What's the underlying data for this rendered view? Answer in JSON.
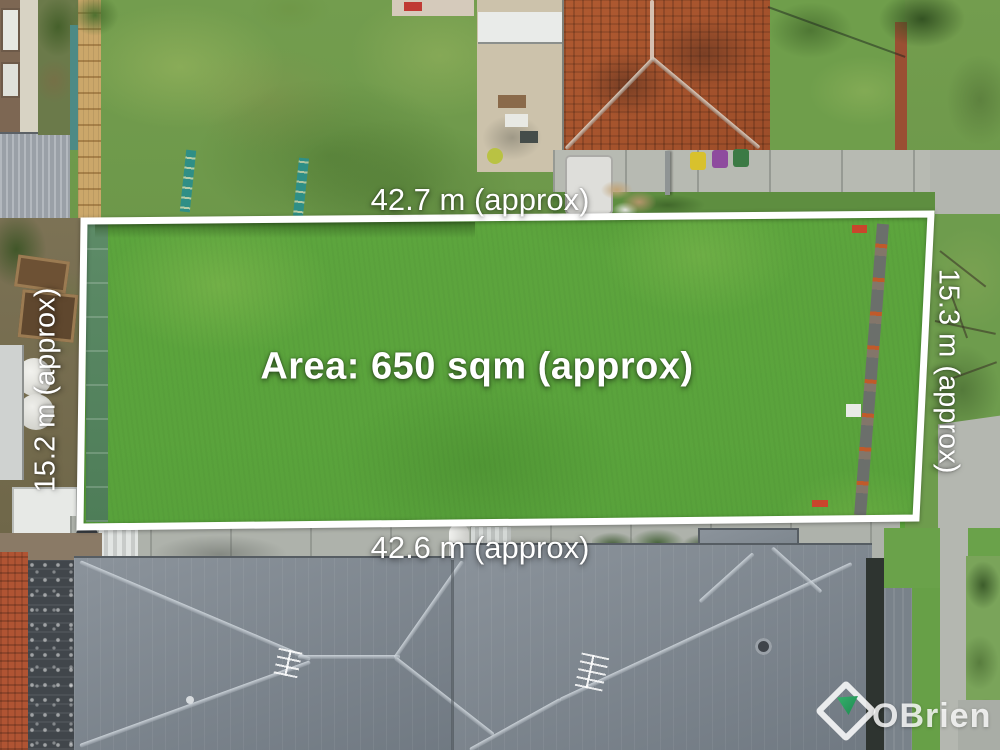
{
  "image": {
    "type": "aerial-property-photo",
    "description": "Drone aerial photo of a vacant grassed land parcel outlined in white, between a tiled-roof house and modern grey-roofed townhouses"
  },
  "annotations": {
    "top_width_label": "42.7 m (approx)",
    "bottom_width_label": "42.6 m (approx)",
    "left_depth_label": "15.2 m (approx)",
    "right_depth_label": "15.3 m (approx)",
    "area_label": "Area: 650 sqm (approx)"
  },
  "watermark": {
    "brand": "OBrien",
    "logo_icon": "diamond-with-green-triangle"
  },
  "colors": {
    "boundary_line": "#ffffff",
    "label_text": "#ffffff",
    "logo_green": "#2aa15d",
    "plot_grass": "#5aa23a",
    "roof_gray": "#7b848c",
    "roof_terracotta": "#a64f2b",
    "concrete": "#b7bab2"
  }
}
